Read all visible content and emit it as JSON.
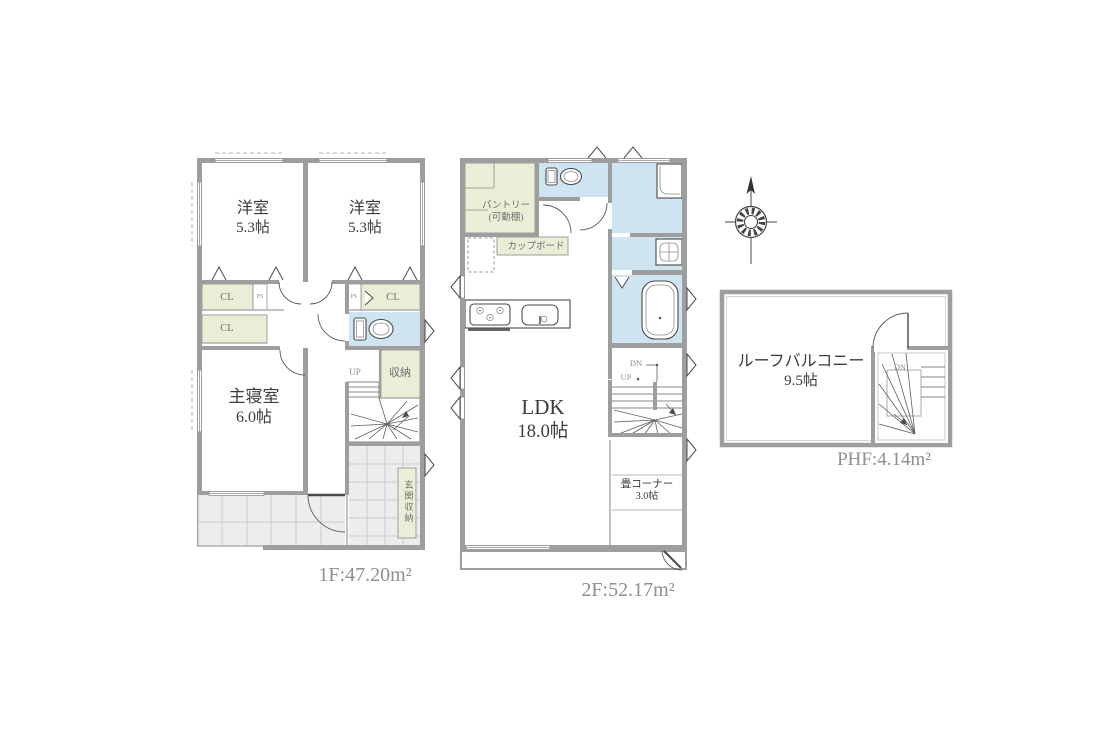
{
  "colors": {
    "wall": "#9e9e9e",
    "closet_green": "#e9efd7",
    "wet_blue": "#cfe4f1",
    "tile_gray": "#ededed",
    "tile_line": "#cccccc",
    "outline_dark": "#4a4a4a",
    "label_dark": "#3c3c3c",
    "label_gray": "#8f8f8f"
  },
  "floor1": {
    "area_label": "1F:47.20m²",
    "rooms": {
      "western1": {
        "name": "洋室",
        "size": "5.3帖"
      },
      "western2": {
        "name": "洋室",
        "size": "5.3帖"
      },
      "master": {
        "name": "主寝室",
        "size": "6.0帖"
      },
      "closet1": "CL",
      "closet2": "CL",
      "closet3": "CL",
      "pipe_space": "PS",
      "storage": "収納",
      "entrance_storage": "玄関収納"
    },
    "stairs_up": "UP"
  },
  "floor2": {
    "area_label": "2F:52.17m²",
    "rooms": {
      "pantry_name": "パントリー",
      "pantry_note": "(可動棚)",
      "cupboard": "カップボード",
      "ldk": {
        "name": "LDK",
        "size": "18.0帖"
      },
      "tatami": {
        "name": "畳コーナー",
        "size": "3.0帖"
      }
    },
    "stairs_down": "DN",
    "stairs_up": "UP"
  },
  "roof": {
    "area_label": "PHF:4.14m²",
    "balcony": {
      "name": "ルーフバルコニー",
      "size": "9.5帖"
    },
    "stairs_down": "DN"
  }
}
